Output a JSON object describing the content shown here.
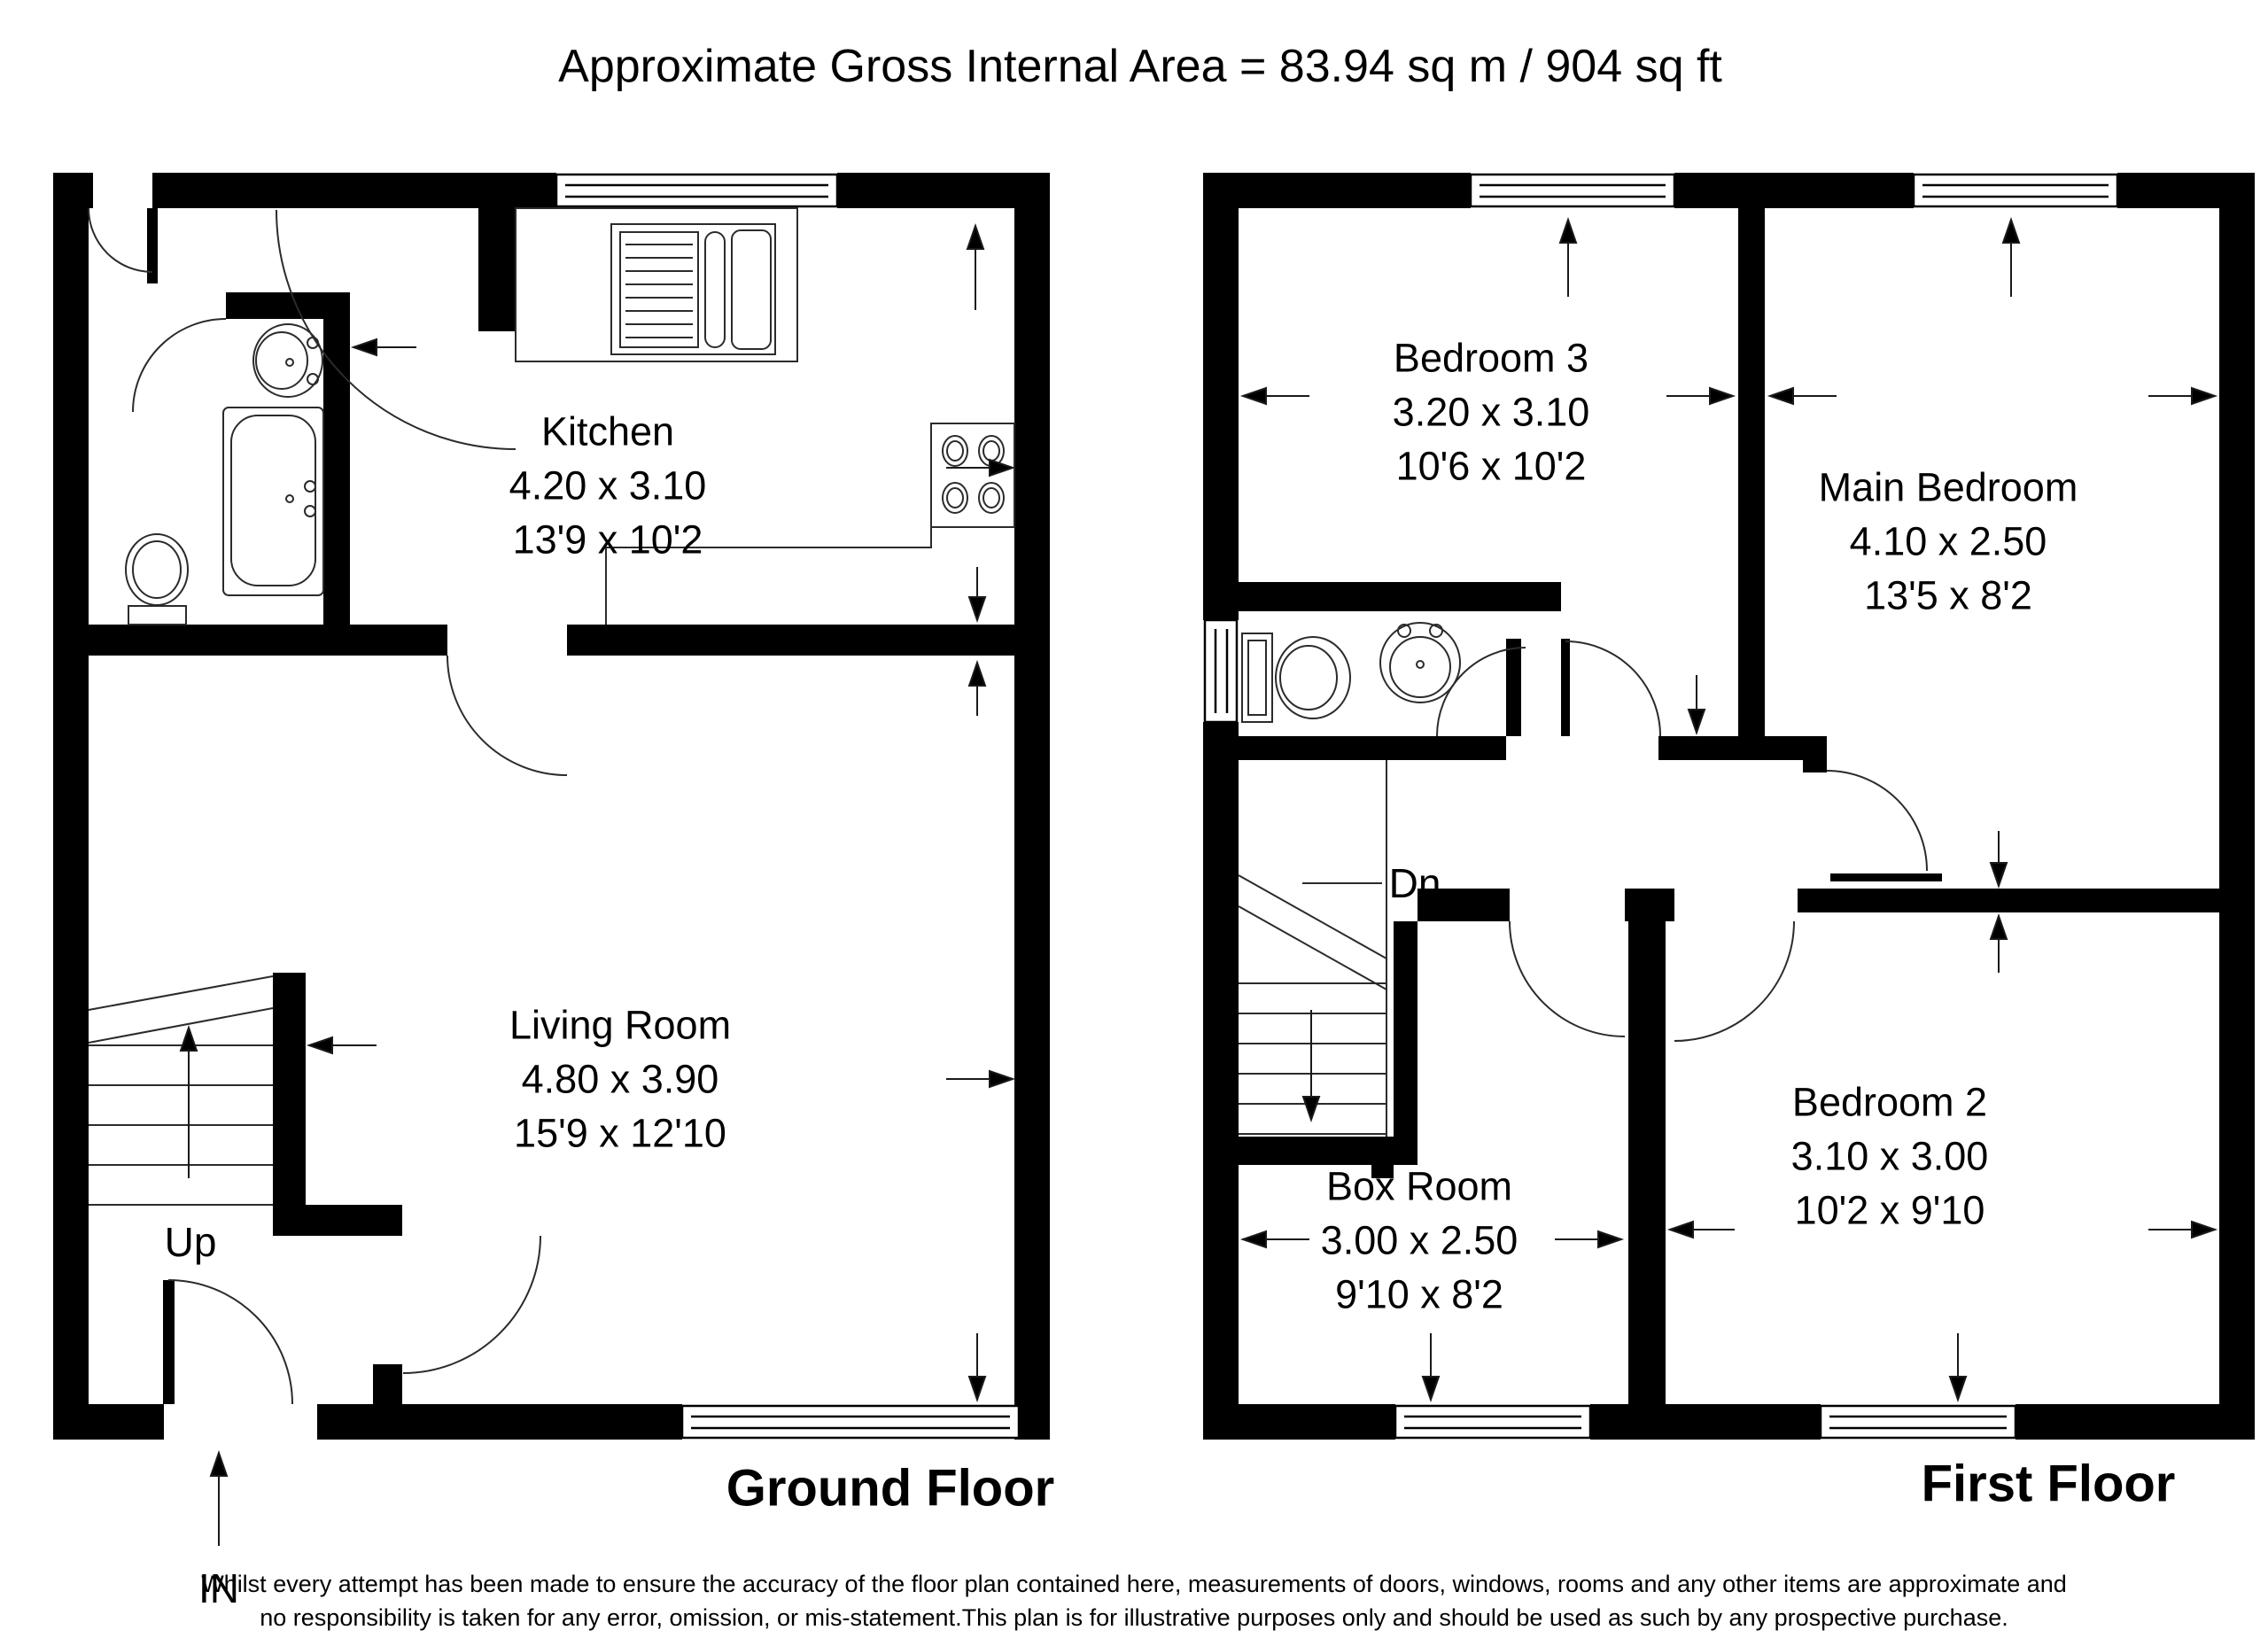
{
  "title": "Approximate Gross Internal Area = 83.94 sq m / 904 sq ft",
  "ground_floor": {
    "label": "Ground Floor",
    "kitchen": {
      "name": "Kitchen",
      "metric": "4.20 x 3.10",
      "imperial": "13'9 x 10'2"
    },
    "living_room": {
      "name": "Living Room",
      "metric": "4.80 x 3.90",
      "imperial": "15'9 x 12'10"
    },
    "up_label": "Up",
    "in_label": "IN"
  },
  "first_floor": {
    "label": "First Floor",
    "bedroom3": {
      "name": "Bedroom 3",
      "metric": "3.20 x 3.10",
      "imperial": "10'6 x 10'2"
    },
    "main_bedroom": {
      "name": "Main Bedroom",
      "metric": "4.10 x 2.50",
      "imperial": "13'5 x 8'2"
    },
    "bedroom2": {
      "name": "Bedroom 2",
      "metric": "3.10 x 3.00",
      "imperial": "10'2 x 9'10"
    },
    "box_room": {
      "name": "Box Room",
      "metric": "3.00 x 2.50",
      "imperial": "9'10 x 8'2"
    },
    "dn_label": "Dn"
  },
  "disclaimer": {
    "line1": "Whilst every attempt has been made to ensure the accuracy of the floor plan contained here, measurements of doors, windows, rooms and any other items are approximate and",
    "line2": "no responsibility is taken for any error, omission, or mis-statement.This plan is for illustrative purposes only and should be used as such by any prospective purchase."
  },
  "colors": {
    "wall": "#000000",
    "background": "#ffffff",
    "line": "#3c3c3c"
  }
}
